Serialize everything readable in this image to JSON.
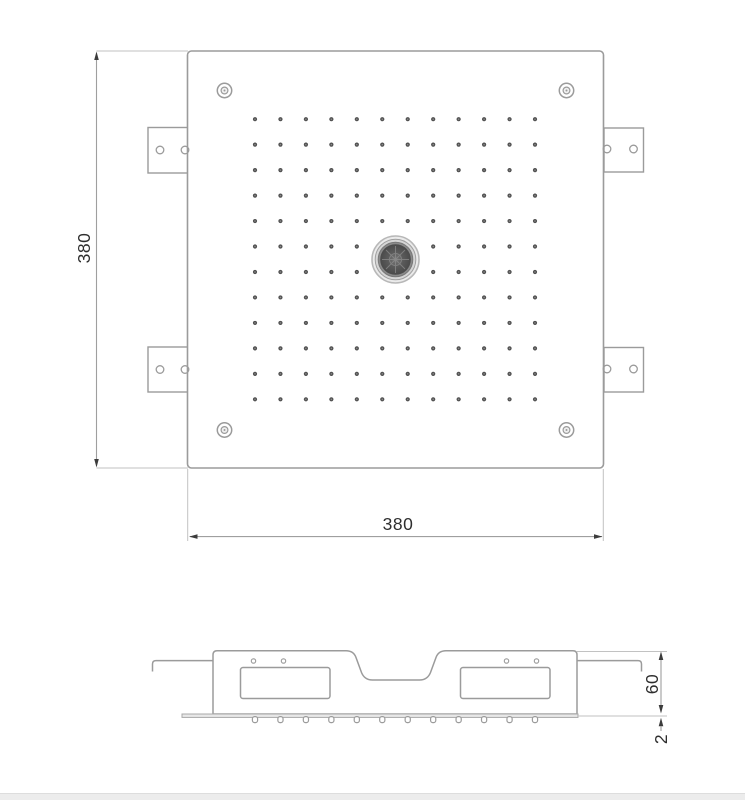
{
  "drawing": {
    "labels": {
      "top_height": "380",
      "top_width": "380",
      "side_depth": "60",
      "side_plate_thickness": "2"
    },
    "top_view": {
      "nozzle_grid": {
        "rows": 12,
        "cols": 12,
        "start_x": 255,
        "start_y": 119.2,
        "spacing_x": 25.455,
        "spacing_y": 25.465,
        "skip_rows": [
          5,
          6
        ],
        "skip_cols": [
          5,
          6
        ],
        "dot_radius": 2.1
      }
    },
    "side_view": {
      "nozzles": {
        "count": 12,
        "start_x": 255,
        "spacing": 25.455,
        "top_y": 716.6,
        "width": 5.2,
        "height": 6
      }
    }
  }
}
